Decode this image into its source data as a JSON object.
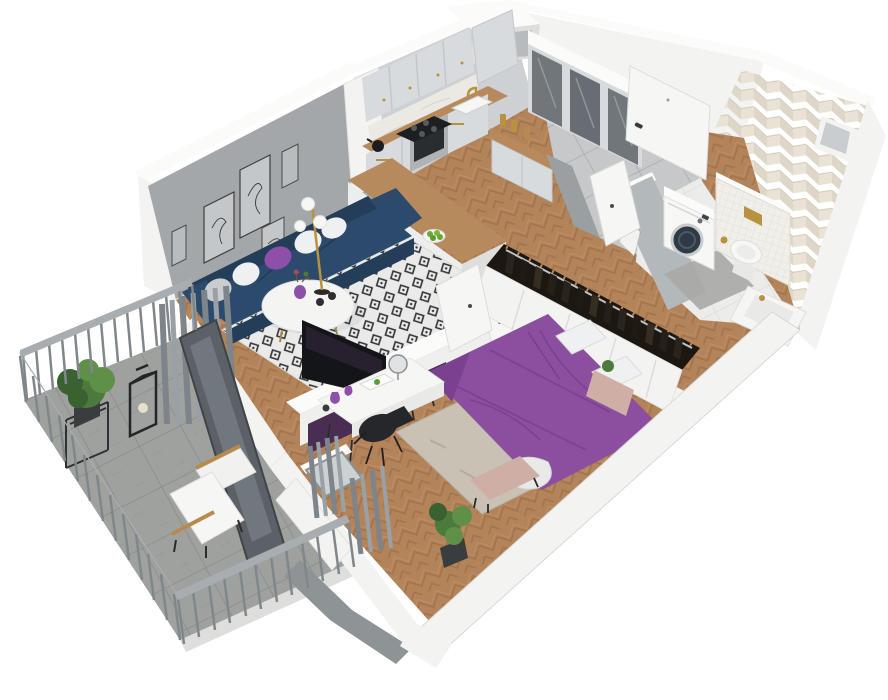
{
  "meta": {
    "description": "Isometric 3D cutaway render of a one-bedroom apartment floor plan",
    "canvas_width": 888,
    "canvas_height": 700
  },
  "scene": {
    "rooms": [
      "living-room",
      "kitchen",
      "entry-hall",
      "bathroom",
      "bedroom",
      "balcony"
    ],
    "objects": [
      "blue-sofa",
      "coffee-table",
      "floor-lamp",
      "wall-art-frames",
      "tv-panel",
      "area-rug",
      "kitchen-cabinets",
      "cooktop",
      "oven",
      "sink",
      "peninsula-counter",
      "bar-stools",
      "mirror-wardrobe",
      "front-door",
      "sideboard",
      "washing-machine",
      "toilet",
      "bathtub",
      "chevron-tile-wall",
      "mosaic-half-wall",
      "purple-bed",
      "wardrobe-with-clothes",
      "desk",
      "desk-chair",
      "bench",
      "nightstand",
      "plants",
      "balcony-railing",
      "lounge-chair",
      "lantern",
      "curtains",
      "balcony-door",
      "bedroom-window"
    ]
  },
  "palette": {
    "background": "#ffffff",
    "wall_rim": "#fbfbfa",
    "wall_white": "#f3f3f1",
    "wall_shadow": "#dededc",
    "wall_dark_edge": "#8e9396",
    "wall_inner_gray": "#a3a7aa",
    "kitchen_wall": "#cdd1d3",
    "partition": "#efefed",
    "halfwall": "#b3b8ba",
    "wood": "#b3835a",
    "wood_dark": "#9c6f46",
    "wood_light": "#c29067",
    "rug_base": "#eaeae8",
    "rug_diamond": "#33373b",
    "bedroom_rug": "#c9c2b4",
    "hall_tile": "#c6c8c9",
    "bath_tile": "#ececea",
    "balcony_floor": "#9fa19f",
    "sofa": "#2c4a6b",
    "sofa_dark": "#243d59",
    "pillow_white": "#eef0f2",
    "pillow_gray": "#c9cdd0",
    "accent_purple": "#8d4fa8",
    "bed_purple": "#8c4fa0",
    "bed_purple_dark": "#7a4190",
    "panel_plum": "#4a2d52",
    "tv_black": "#141518",
    "chair_black": "#26272a",
    "desk_white": "#f6f6f4",
    "table_white": "#f4f4f2",
    "door_white": "#f6f6f4",
    "gold": "#b8923f",
    "cabinet": "#d8dbdd",
    "cabinet_line": "#c0c4c6",
    "counter_wood": "#b78a5e",
    "marble": "#ece9e4",
    "steel": "#aeb3b6",
    "curtain": "#7d848a",
    "curtain_light": "#9aa1a6",
    "railing": "#a7adb0",
    "railing_bar": "#80878b",
    "glass_dark": "#5b6166",
    "plant_green": "#4c7a3c",
    "plant_light": "#5f9048",
    "plant_dark": "#3a6130",
    "chevron_a": "#ded7c8",
    "chevron_b": "#e9e3d6",
    "mosaic": "#f1efe9",
    "washer_drum": "#2f3a45",
    "clothes_dark": "#241f19",
    "hanger_tan": "#b98a50",
    "bench_pink": "#cfaea6",
    "stool": "#8d9599"
  }
}
